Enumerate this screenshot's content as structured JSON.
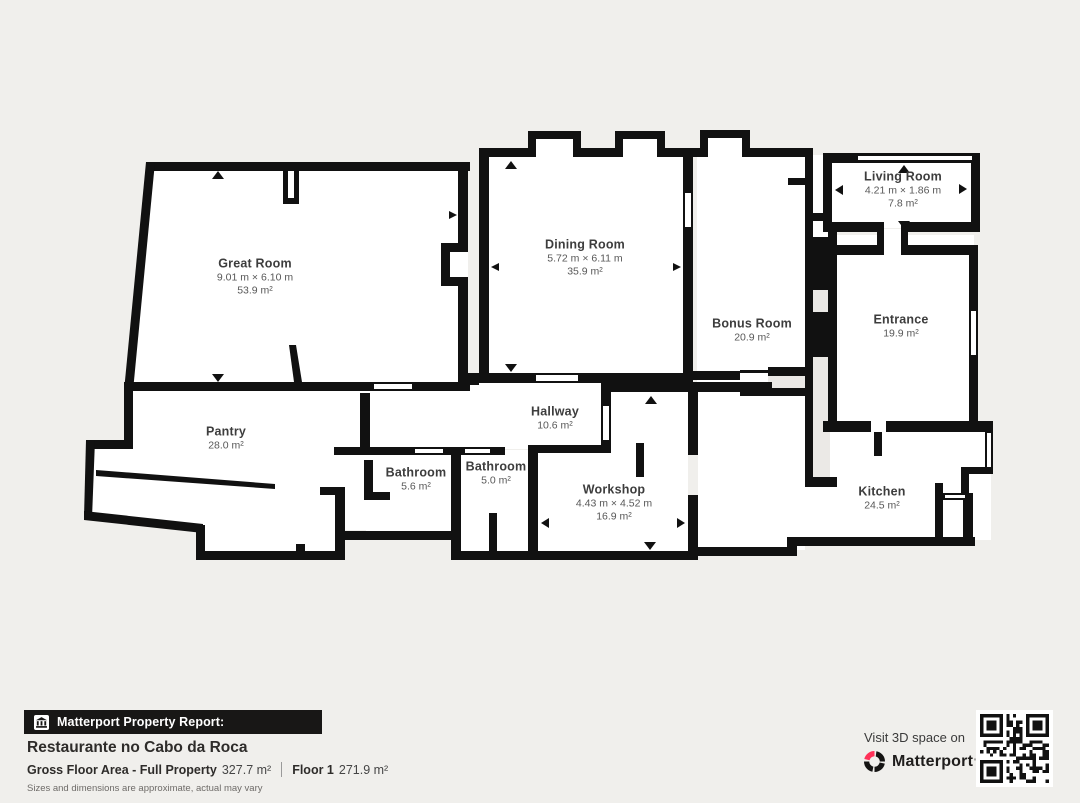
{
  "plan": {
    "rooms": {
      "great_room": {
        "name": "Great Room",
        "dims": "9.01 m × 6.10 m",
        "area": "53.9 m²"
      },
      "dining_room": {
        "name": "Dining Room",
        "dims": "5.72 m × 6.11 m",
        "area": "35.9 m²"
      },
      "bonus_room": {
        "name": "Bonus Room",
        "area": "20.9 m²"
      },
      "living_room": {
        "name": "Living Room",
        "dims": "4.21 m × 1.86 m",
        "area": "7.8 m²"
      },
      "entrance": {
        "name": "Entrance",
        "area": "19.9 m²"
      },
      "pantry": {
        "name": "Pantry",
        "area": "28.0 m²"
      },
      "hallway": {
        "name": "Hallway",
        "area": "10.6 m²"
      },
      "bathroom_1": {
        "name": "Bathroom",
        "area": "5.6 m²"
      },
      "bathroom_2": {
        "name": "Bathroom",
        "area": "5.0 m²"
      },
      "workshop": {
        "name": "Workshop",
        "dims": "4.43 m × 4.52 m",
        "area": "16.9 m²"
      },
      "kitchen": {
        "name": "Kitchen",
        "area": "24.5 m²"
      }
    }
  },
  "footer": {
    "report_label": "Matterport Property Report:",
    "property_name": "Restaurante no Cabo da Roca",
    "gfa_label": "Gross Floor Area - Full Property",
    "gfa_value": "327.7 m²",
    "floor_label": "Floor 1",
    "floor_value": "271.9 m²",
    "disclaimer": "Sizes and dimensions are approximate, actual may vary"
  },
  "cta": {
    "visit_label": "Visit 3D space on",
    "brand": "Matterport",
    "brand_mark": "ʹ"
  },
  "colors": {
    "wall": "#111111",
    "background": "#f0efec",
    "room_fill": "#ffffff",
    "void_fill": "#ebe9e6",
    "bar_background": "#181716",
    "accent_red": "#ff3158"
  }
}
